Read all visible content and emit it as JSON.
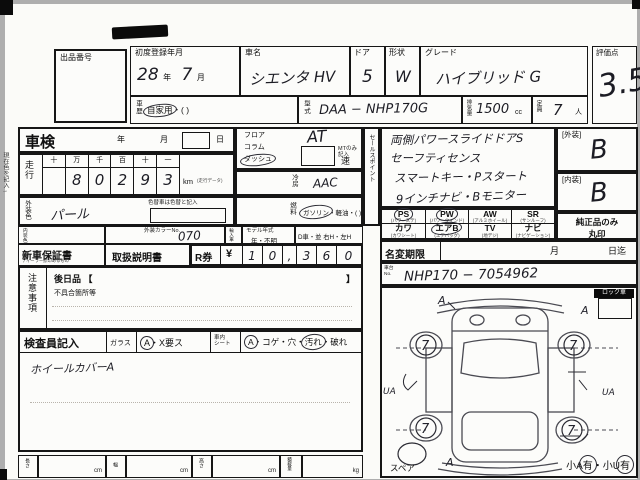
{
  "header": {
    "auction_no_label": "出品番号",
    "score_label": "評価点",
    "score_value": "3.5",
    "row1": {
      "reg_label": "初度登録年月",
      "reg_year": "28",
      "reg_year_unit": "年",
      "reg_month": "7",
      "reg_month_unit": "月",
      "name_label": "車名",
      "name_value": "シエンタ HV",
      "door_label": "ドア",
      "door_value": "5",
      "shape_label": "形状",
      "shape_value": "W",
      "grade_label": "グレード",
      "grade_value": "ハイブリッド G"
    },
    "row2": {
      "history_label": "車歴",
      "history_circled": "自家用",
      "history_rest": "・(        )",
      "model_label": "型式",
      "model_value": "DAA − NHP170G",
      "disp_label": "排気量",
      "disp_value": "1500",
      "disp_unit": "cc",
      "cap_label": "定員",
      "cap_value": "7",
      "cap_unit": "人"
    }
  },
  "left": {
    "side_note": "現在色を記入→",
    "shaken": {
      "label": "車検",
      "year": "年",
      "month": "月",
      "day": "日"
    },
    "mileage": {
      "label": "走行",
      "cols": [
        "十",
        "万",
        "千",
        "百",
        "十",
        "一"
      ],
      "digits": [
        "",
        "8",
        "0",
        "2",
        "9",
        "3"
      ],
      "unit": "km",
      "unit_note": "(走行データ)",
      "repaint_note": "色替車は色替と記入"
    },
    "ext_color": {
      "label": "外装色",
      "value": "パール"
    },
    "int_color": {
      "label": "内装色",
      "value": ""
    },
    "color_no": {
      "label": "外装カラーNo.",
      "value": "070"
    },
    "import_label": "輸入車",
    "model_year": {
      "label": "モデル年式",
      "value": "年・不明"
    },
    "dcar": "D車・並 右H・左H",
    "warranty": {
      "label": "新車保証書",
      "sub": "ディーラー捺印あるもの",
      "manual": "取扱説明書",
      "r_label": "R券",
      "yen": "¥",
      "digits": [
        "1",
        "0",
        ",",
        "3",
        "6",
        "0"
      ]
    },
    "notes": {
      "label": "注意事項",
      "later": "後日品 【",
      "later_close": "】",
      "defect": "不具合箇所等"
    },
    "inspector": {
      "label": "検査員記入",
      "glass_label": "ガラス",
      "glass_mark": "A",
      "glass_rest": "・X要ス",
      "seat_label1": "車内",
      "seat_label2": "シート",
      "seat_mark": "A",
      "seat_rest1": "・コゲ・穴・",
      "seat_dirty": "汚れ",
      "seat_rest2": "・破れ",
      "note": "ホイールカバーA"
    },
    "dims": [
      {
        "label": "長さ",
        "unit": "cm"
      },
      {
        "label": "幅",
        "unit": "cm"
      },
      {
        "label": "高さ",
        "unit": "cm"
      },
      {
        "label": "積載量",
        "unit": "kg"
      }
    ]
  },
  "middle": {
    "pos_labels": [
      "フロア",
      "コラム",
      "ダッシュ"
    ],
    "at_value": "AT",
    "mt_note": "MTのみ記入",
    "speed": "速",
    "aircon_label": "冷房",
    "aircon_value": "AAC",
    "fuel_label": "燃料",
    "fuel_circled": "ガソリン",
    "fuel_rest": "・軽油・(        )"
  },
  "right": {
    "sales_label": "セールスポイント",
    "sales_lines": [
      "両側パワースライドドアS",
      "セーフティセンス",
      "スマートキー・Pスタート",
      "9インチナビ・Bモニター"
    ],
    "ext_grade_label": "[外装]",
    "ext_grade": "B",
    "int_grade_label": "[内装]",
    "int_grade": "B",
    "equipment": [
      {
        "code": "PS",
        "sub": "(パワーステ)",
        "circled": true
      },
      {
        "code": "PW",
        "sub": "(パワーウィンド)",
        "circled": true
      },
      {
        "code": "AW",
        "sub": "(アルミホイール)",
        "circled": false
      },
      {
        "code": "SR",
        "sub": "(サンルーフ)",
        "circled": false
      },
      {
        "code": "カワ",
        "sub": "(カワシート)",
        "circled": false
      },
      {
        "code": "エアB",
        "sub": "(エアバッグ)",
        "circled": true
      },
      {
        "code": "TV",
        "sub": "(地デジ)",
        "circled": false
      },
      {
        "code": "ナビ",
        "sub": "(ナビゲーション)",
        "circled": false
      }
    ],
    "genuine_note1": "純正品のみ",
    "genuine_note2": "丸印",
    "name_change": {
      "label": "名変期限",
      "month": "月",
      "until": "日迄"
    },
    "chassis_label1": "車台",
    "chassis_label2": "No.",
    "chassis_value": "NHP170 − 7054962",
    "lock_label": "ロック車",
    "diagram": {
      "wheel_mark": "7",
      "mark_tl": "A",
      "mark_tr": "A",
      "mark_left": "UA",
      "mark_right": "UA",
      "mark_bl": "A",
      "spare_label": "スペア",
      "small_a": "小A",
      "small_a_mark": "有",
      "sep": "・",
      "small_u": "小U",
      "small_u_mark": "有"
    }
  }
}
